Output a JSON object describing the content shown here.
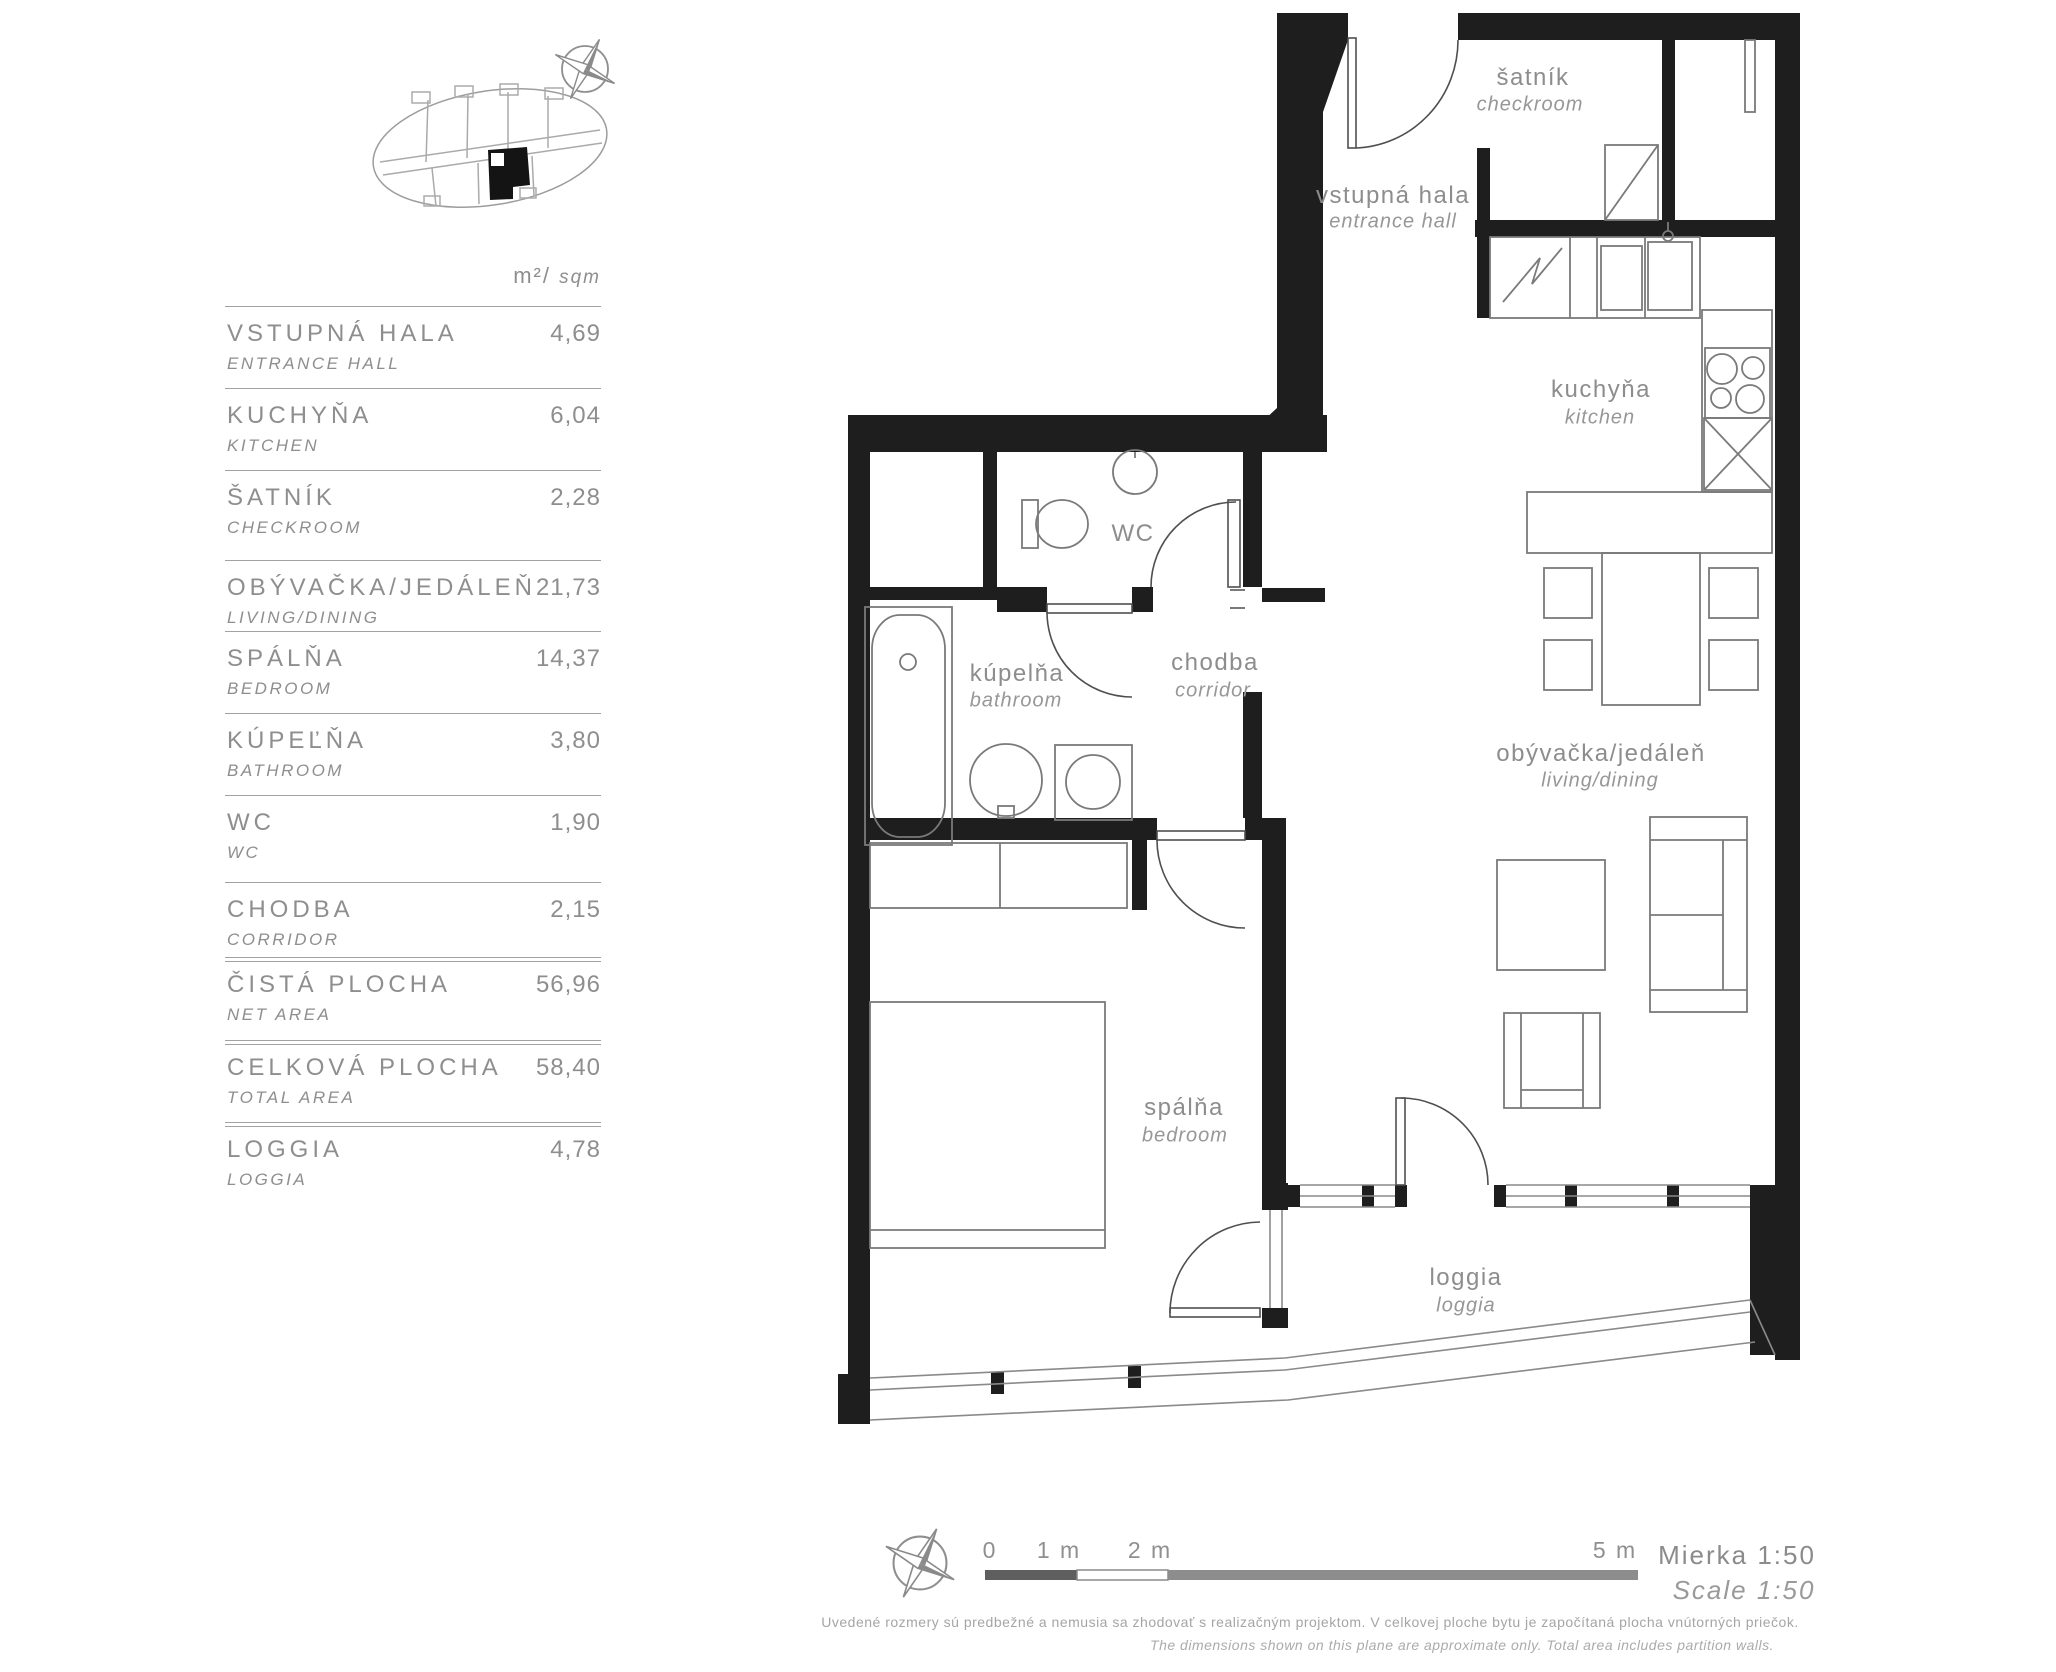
{
  "colors": {
    "wall": "#1e1e1e",
    "thin_line": "#7a7a7a",
    "label": "#8d8d8d",
    "legend_line": "#a2a2a2",
    "scalebar_dark": "#5f5f5f",
    "scalebar_light": "#ffffff",
    "scalebar_mid": "#8d8d8d"
  },
  "legend": {
    "unit_header": {
      "m2": "m²/",
      "sqm": "sqm"
    },
    "rows": [
      {
        "title": "VSTUPNÁ HALA",
        "subtitle": "ENTRANCE HALL",
        "value": "4,69",
        "divider": "single"
      },
      {
        "title": "KUCHYŇA",
        "subtitle": "KITCHEN",
        "value": "6,04",
        "divider": "single"
      },
      {
        "title": "ŠATNÍK",
        "subtitle": "CHECKROOM",
        "value": "2,28",
        "divider": "single"
      },
      {
        "title": "OBÝVAČKA/JEDÁLEŇ",
        "subtitle": "LIVING/DINING",
        "value": "21,73",
        "divider": "single"
      },
      {
        "title": "SPÁLŇA",
        "subtitle": "BEDROOM",
        "value": "14,37",
        "divider": "single"
      },
      {
        "title": "KÚPEĽŇA",
        "subtitle": "BATHROOM",
        "value": "3,80",
        "divider": "single"
      },
      {
        "title": "WC",
        "subtitle": "WC",
        "value": "1,90",
        "divider": "single"
      },
      {
        "title": "CHODBA",
        "subtitle": "CORRIDOR",
        "value": "2,15",
        "divider": "single"
      },
      {
        "title": "ČISTÁ PLOCHA",
        "subtitle": "NET AREA",
        "value": "56,96",
        "divider": "double"
      },
      {
        "title": "CELKOVÁ PLOCHA",
        "subtitle": "TOTAL AREA",
        "value": "58,40",
        "divider": "double"
      },
      {
        "title": "LOGGIA",
        "subtitle": "LOGGIA",
        "value": "4,78",
        "divider": "double"
      }
    ]
  },
  "plan_labels": [
    {
      "id": "satnik",
      "name": "šatník",
      "name_en": "checkroom"
    },
    {
      "id": "vstupna-hala",
      "name": "vstupná hala",
      "name_en": "entrance hall"
    },
    {
      "id": "kuchyna",
      "name": "kuchyňa",
      "name_en": "kitchen"
    },
    {
      "id": "wc",
      "name": "WC",
      "name_en": ""
    },
    {
      "id": "chodba",
      "name": "chodba",
      "name_en": "corridor"
    },
    {
      "id": "kupelna",
      "name": "kúpelňa",
      "name_en": "bathroom"
    },
    {
      "id": "obyvacka",
      "name": "obývačka/jedáleň",
      "name_en": "living/dining"
    },
    {
      "id": "spalna",
      "name": "spálňa",
      "name_en": "bedroom"
    },
    {
      "id": "loggia",
      "name": "loggia",
      "name_en": "loggia"
    }
  ],
  "scale_bar": {
    "tick0": "0",
    "tick1": "1 m",
    "tick2": "2 m",
    "tick5": "5 m",
    "scale_sk": "Mierka 1:50",
    "scale_en": "Scale 1:50"
  },
  "footer": {
    "disclaimer_sk": "Uvedené rozmery sú predbežné a nemusia sa zhodovať s realizačným projektom. V celkovej ploche bytu je započítaná plocha vnútorných priečok.",
    "disclaimer_en": "The dimensions shown on this plane are approximate only. Total area includes partition walls."
  }
}
